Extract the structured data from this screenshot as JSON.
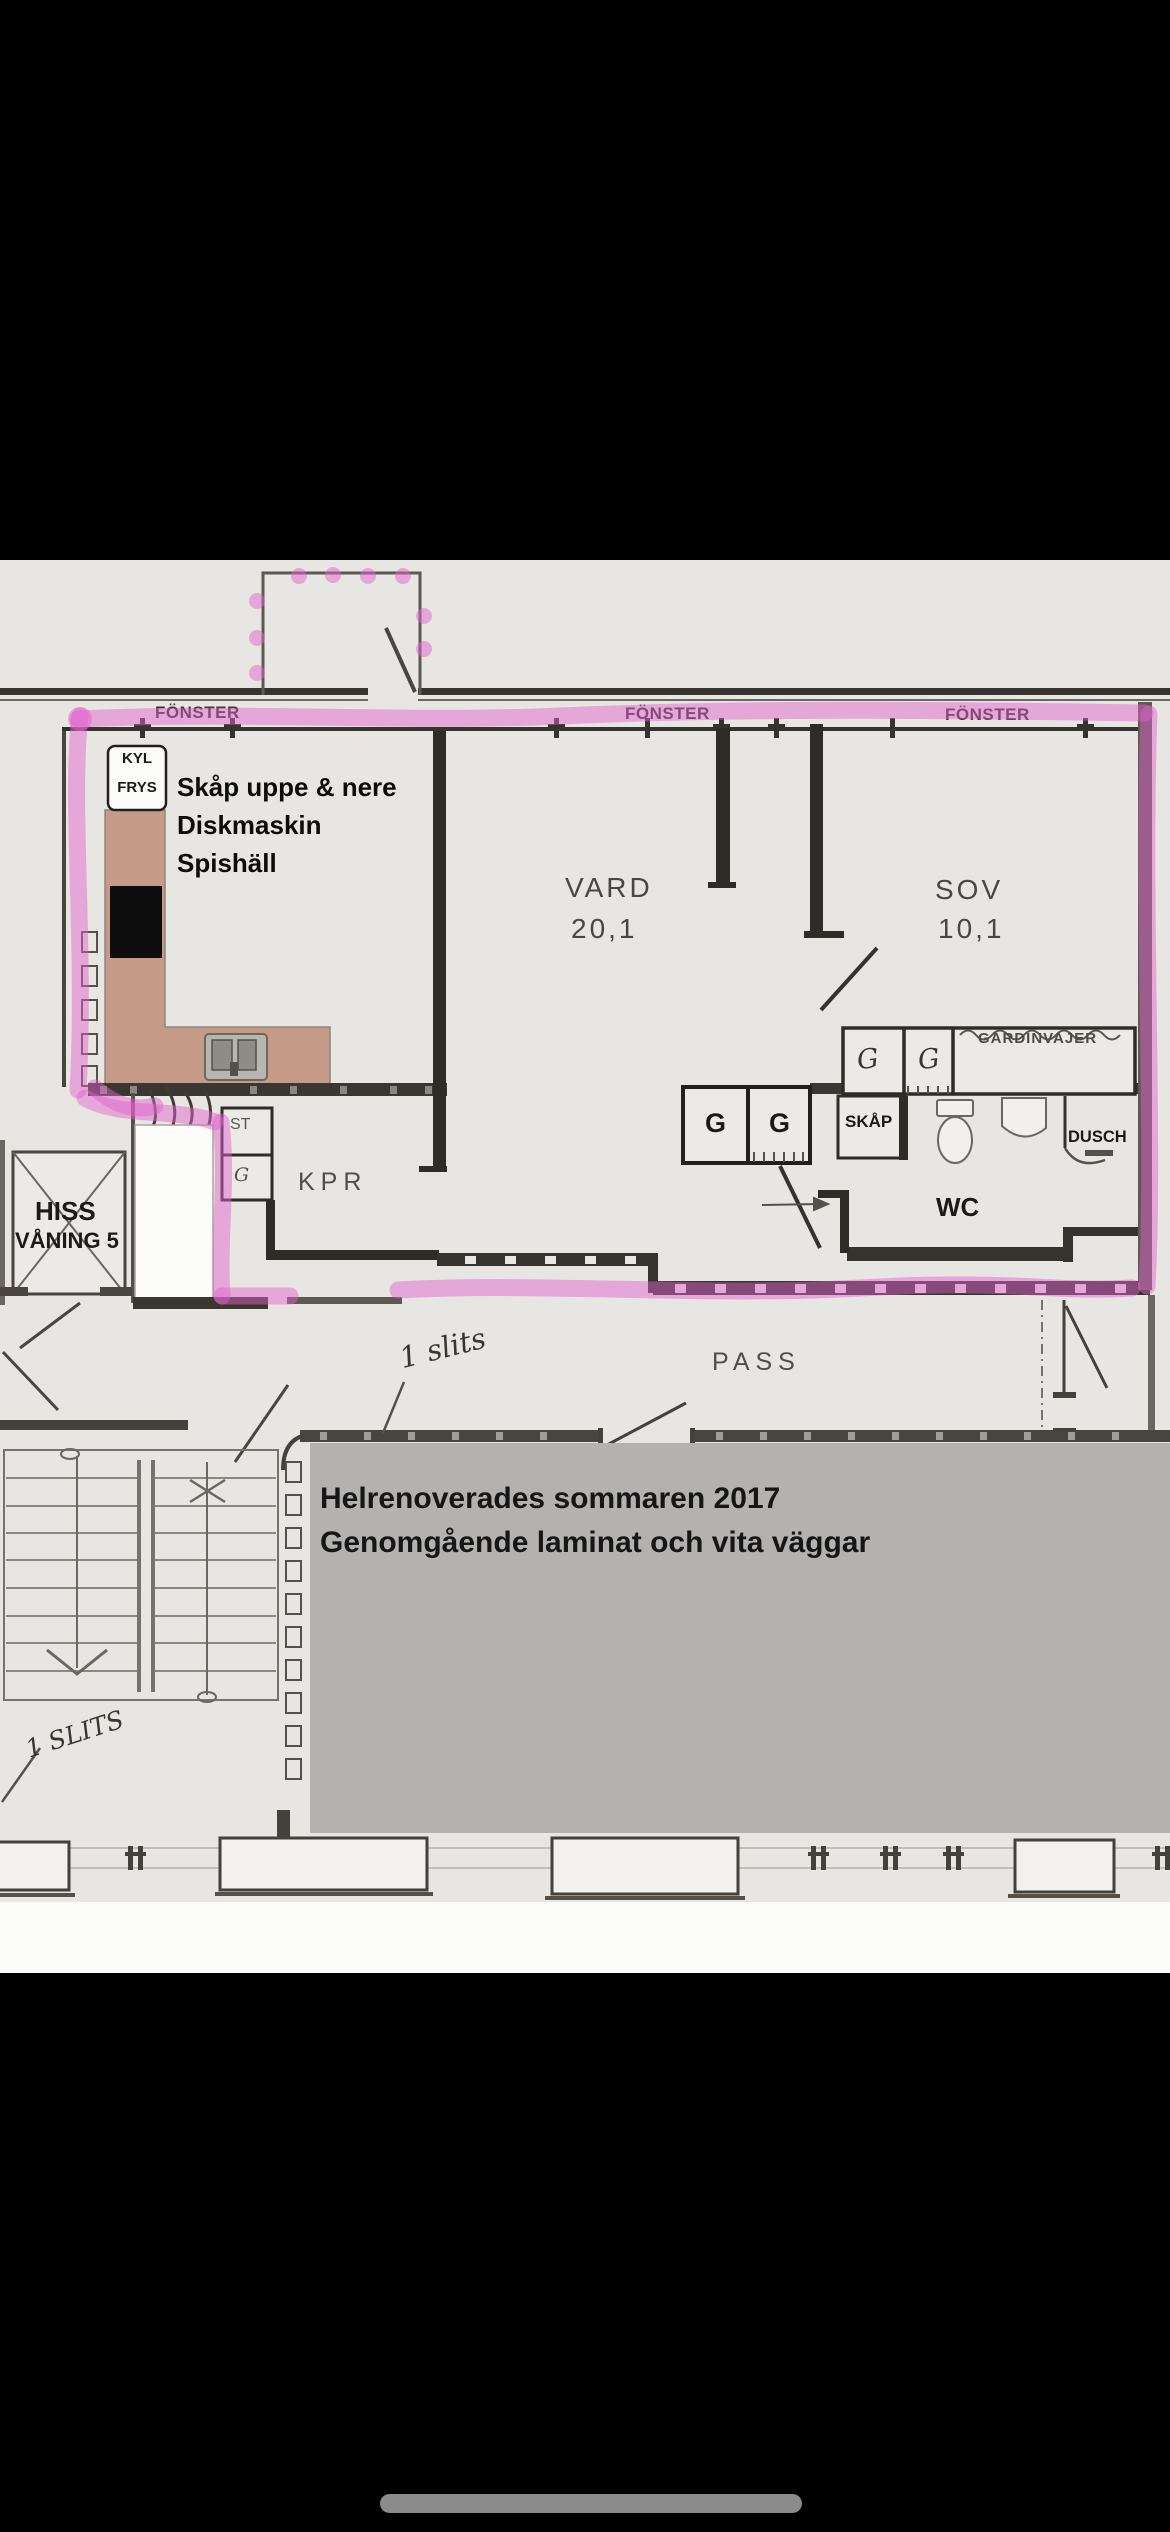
{
  "plan": {
    "windows": [
      {
        "label": "FÖNSTER"
      },
      {
        "label": "FÖNSTER"
      },
      {
        "label": "FÖNSTER"
      }
    ],
    "kitchen": {
      "fridge": {
        "line1": "KYL",
        "line2": "FRYS"
      },
      "note": {
        "line1": "Skåp uppe & nere",
        "line2": "Diskmaskin",
        "line3": "Spishäll"
      }
    },
    "living": {
      "name": "VARD",
      "area": "20,1"
    },
    "bedroom": {
      "name": "SOV",
      "area": "10,1",
      "curtain_label": "GARDINVAJER",
      "closet_g1": "G",
      "closet_g2": "G"
    },
    "bath": {
      "wc": "WC",
      "shower": "DUSCH",
      "cabinet": "SKÅP"
    },
    "hall": {
      "name": "KPR",
      "closet_st": "ST",
      "closet_g": "G",
      "wardrobe_g1": "G",
      "wardrobe_g2": "G"
    },
    "elevator": {
      "line1": "HISS",
      "line2": "VÅNING 5"
    },
    "passage": {
      "name": "PASS"
    },
    "handwritten": {
      "note1": "1 slits",
      "note2": "1 SLITS"
    },
    "renovation_note": {
      "line1": "Helrenoverades sommaren 2017",
      "line2": "Genomgående laminat och vita väggar"
    }
  },
  "colors": {
    "highlight": "#e063cc",
    "counter": "#c59b88",
    "note_box": "#b3b2b1",
    "paper": "#e8e6e3",
    "home_indicator": "#8b8b8b"
  }
}
